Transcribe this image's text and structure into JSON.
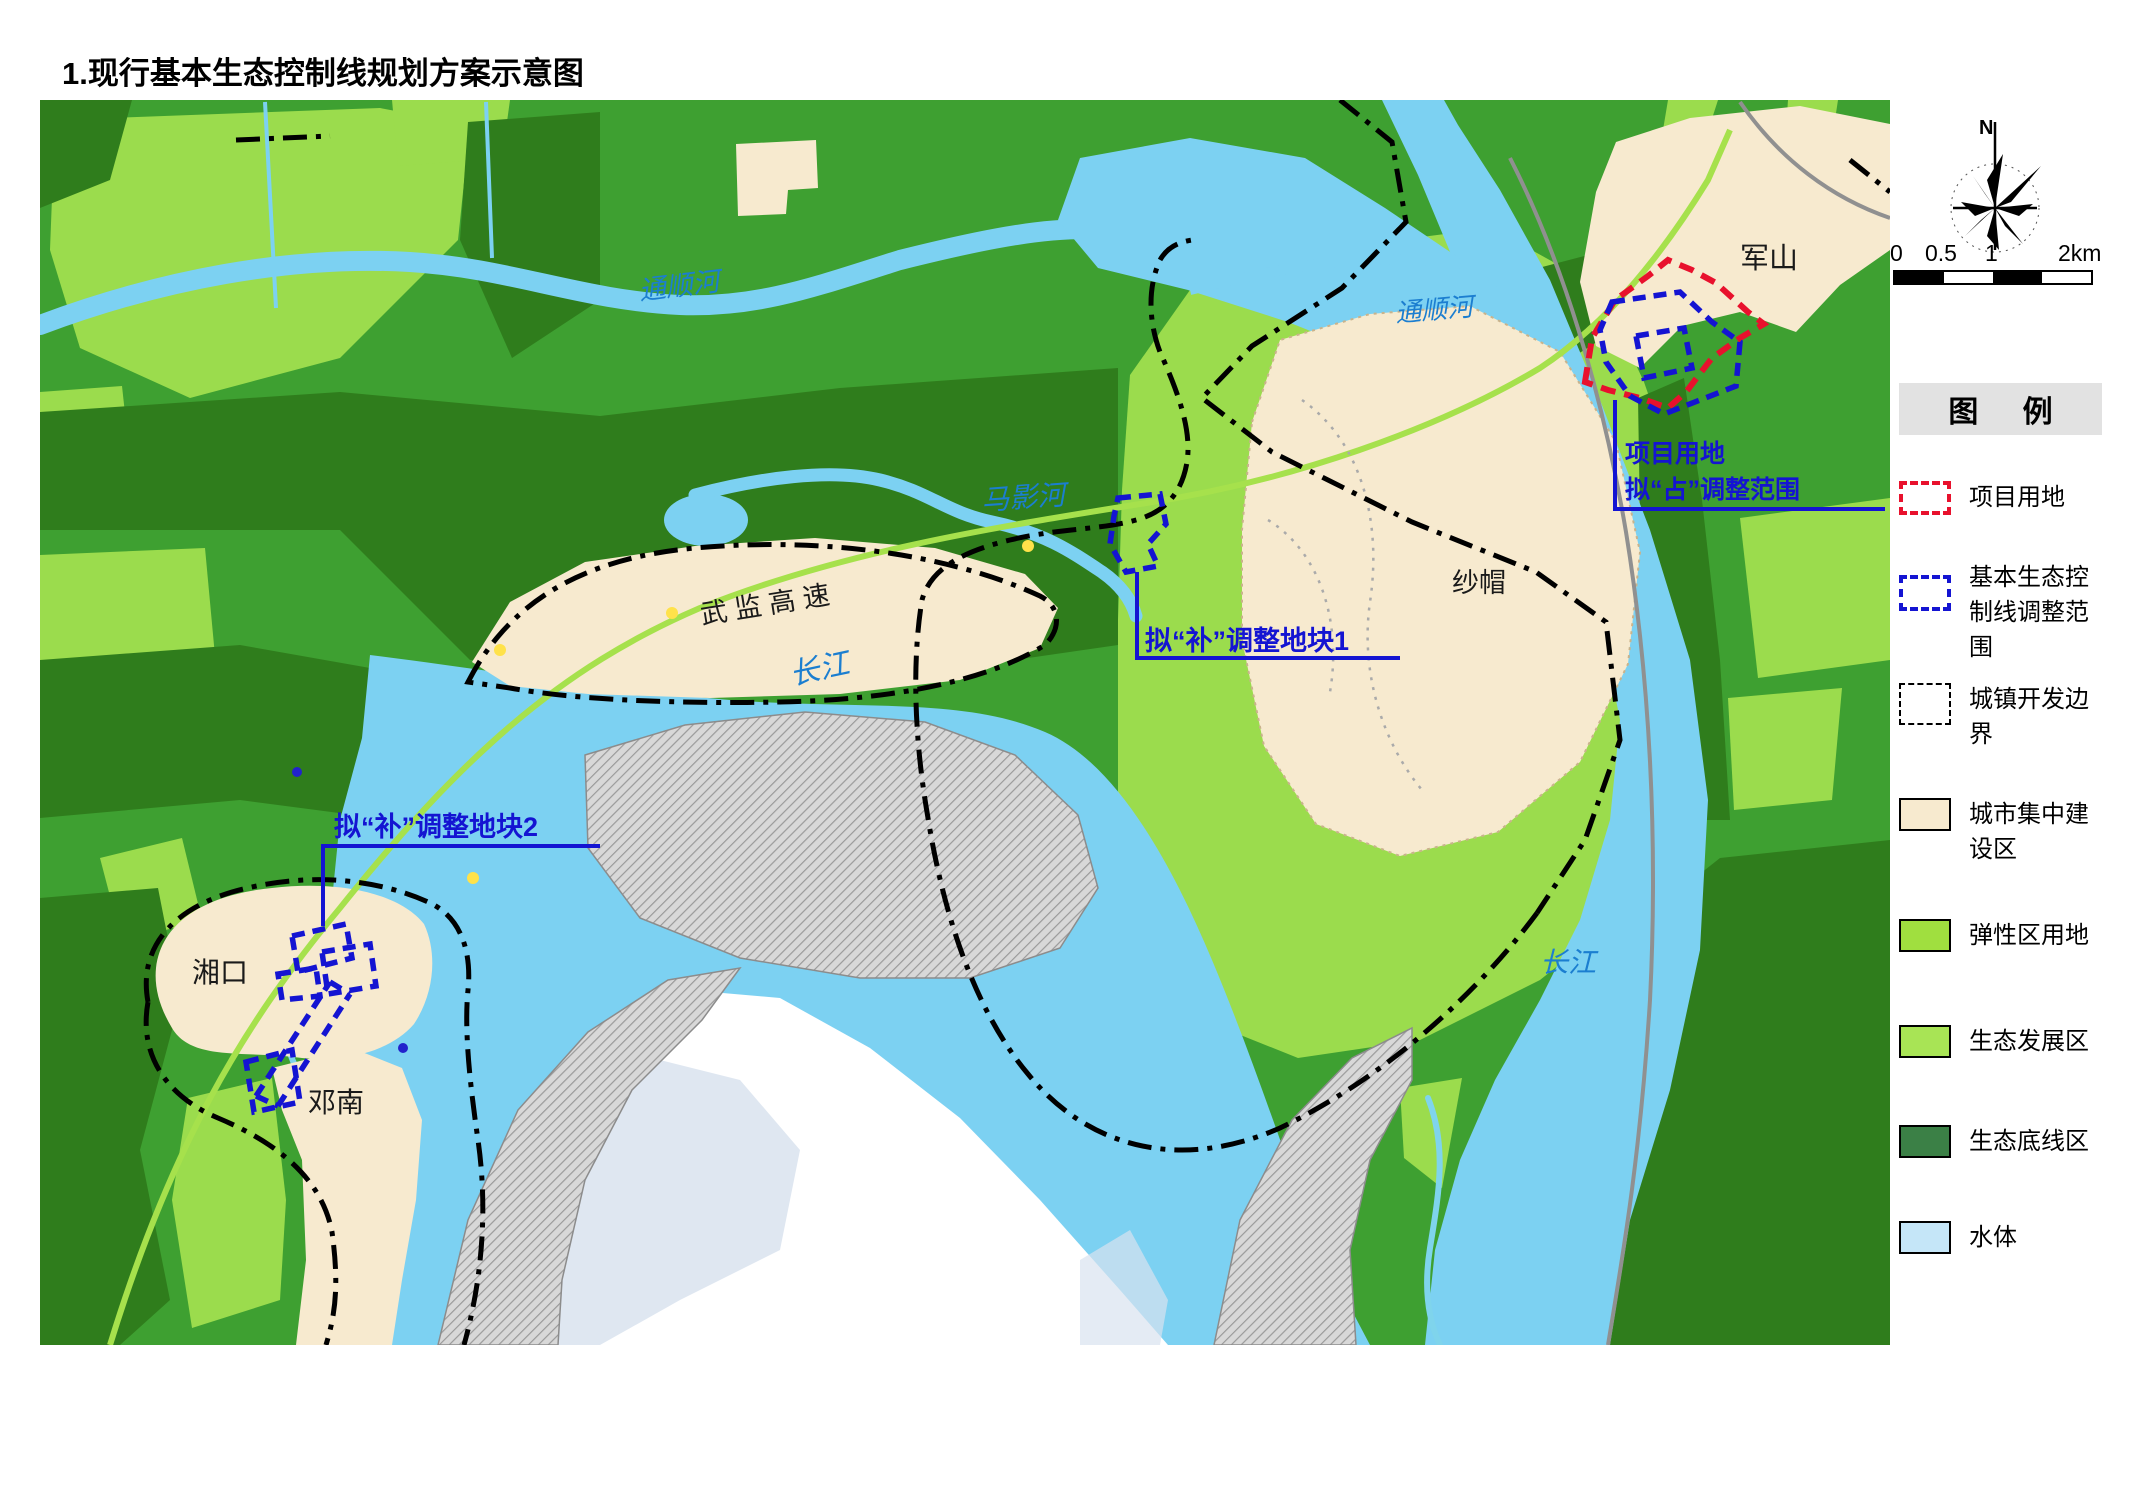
{
  "title": "1.现行基本生态控制线规划方案示意图",
  "map": {
    "place_labels": [
      {
        "id": "junshan",
        "label": "军山"
      },
      {
        "id": "shamao",
        "label": "纱帽"
      },
      {
        "id": "xiangkou",
        "label": "湘口"
      },
      {
        "id": "dengnan",
        "label": "邓南"
      },
      {
        "id": "expressway",
        "label": "武 监 高 速"
      }
    ],
    "river_labels": [
      {
        "id": "tongshunhe-1",
        "label": "通顺河"
      },
      {
        "id": "tongshunhe-2",
        "label": "通顺河"
      },
      {
        "id": "mayinghe",
        "label": "马影河"
      },
      {
        "id": "changjiang-1",
        "label": "长江"
      },
      {
        "id": "changjiang-2",
        "label": "长江"
      }
    ],
    "annotations": [
      {
        "id": "plot1",
        "label": "拟“补”调整地块1"
      },
      {
        "id": "plot2",
        "label": "拟“补”调整地块2"
      },
      {
        "id": "project",
        "line1": "项目用地",
        "line2": "拟“占”调整范围"
      }
    ]
  },
  "compass": {
    "north_label": "N"
  },
  "scale_bar": {
    "ticks": [
      "0",
      "0.5",
      "1",
      "2km"
    ]
  },
  "legend": {
    "header": "图  例",
    "items": [
      {
        "label": "项目用地",
        "symbol": "red-dashed-outline",
        "color": "#E8112D"
      },
      {
        "label": "基本生态控制线调整范围",
        "symbol": "blue-dashed-outline",
        "color": "#1414D2"
      },
      {
        "label": "城镇开发边界",
        "symbol": "black-dashdot-outline",
        "color": "#000000"
      },
      {
        "label": "城市集中建设区",
        "symbol": "fill",
        "color": "#F7EACF"
      },
      {
        "label": "弹性区用地",
        "symbol": "fill",
        "color": "#A0DF3F"
      },
      {
        "label": "生态发展区",
        "symbol": "fill",
        "color": "#A8E455"
      },
      {
        "label": "生态底线区",
        "symbol": "fill",
        "color": "#3B8046"
      },
      {
        "label": "水体",
        "symbol": "fill",
        "color": "#C5E6F8"
      }
    ]
  },
  "colors": {
    "land_green": "#3EA031",
    "dark_green": "#2F7D1C",
    "light_green": "#9BDC4D",
    "water": "#7CD1F2",
    "urban_beige": "#F7EACF",
    "shoal_gray": "#C9C9C9",
    "annotation_blue": "#1414D2",
    "project_red": "#E8112D"
  }
}
